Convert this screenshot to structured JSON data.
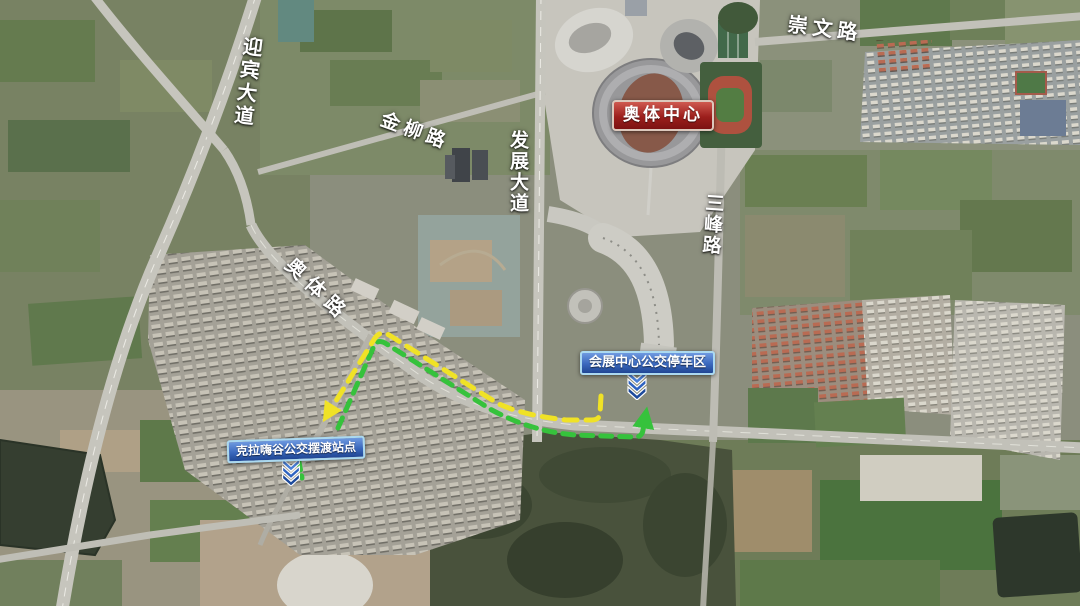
{
  "map": {
    "kind": "annotated-satellite-map",
    "labels": {
      "yingbin": "迎宾大道",
      "jinliu": "金柳路",
      "fazhan": "发展大道",
      "aoti_road": "奥体路",
      "chongwen": "崇文路",
      "sanfeng": "三峰路"
    },
    "pois": {
      "aoti_center": "奥体中心",
      "expo_parking": "会展中心公交停车区",
      "kela_station": "克拉嗨谷公交摆渡站点"
    },
    "routes": {
      "yellow": {
        "color": "#f0e226",
        "style": "dashed"
      },
      "green": {
        "color": "#36c23c",
        "style": "dashed"
      }
    },
    "marker_color": "#2e63c0"
  }
}
